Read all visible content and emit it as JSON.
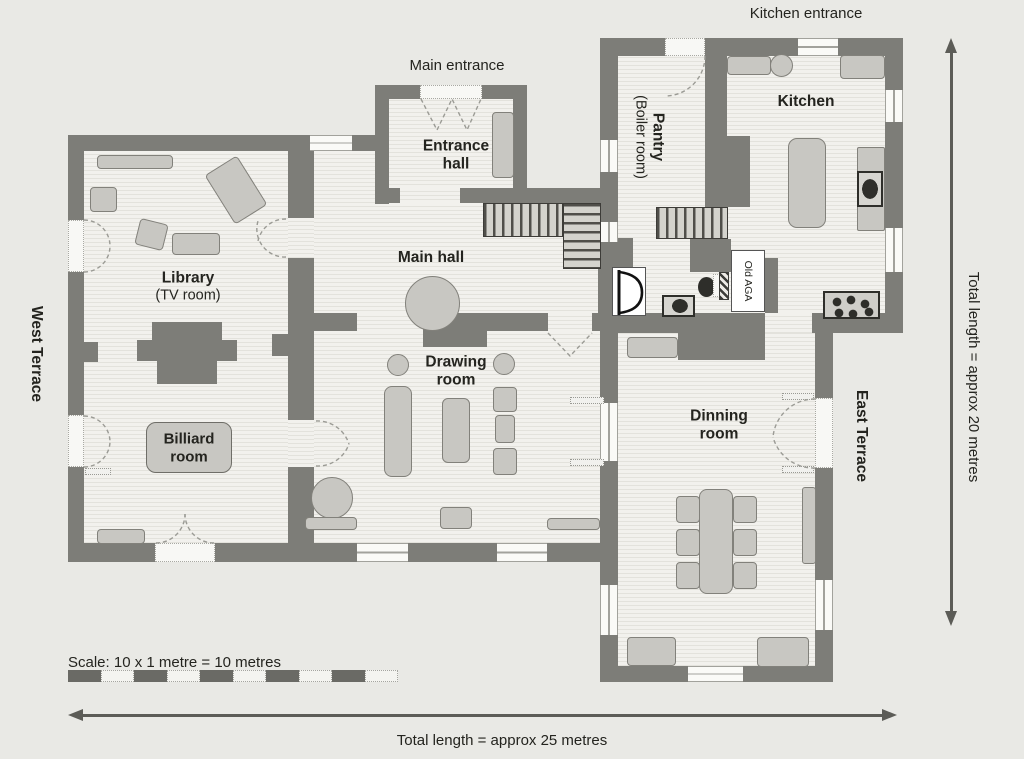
{
  "annotations": {
    "kitchen_entrance": "Kitchen entrance",
    "main_entrance": "Main entrance",
    "west_terrace": "West Terrace",
    "east_terrace": "East Terrace",
    "scale_label": "Scale: 10 x 1 metre = 10 metres",
    "total_width_label": "Total length = approx 25 metres",
    "total_height_label": "Total length = approx 20 metres"
  },
  "rooms": {
    "library": {
      "name": "Library",
      "subtitle": "(TV room)"
    },
    "billiard": {
      "line1": "Billiard",
      "line2": "room"
    },
    "entrance_hall": {
      "line1": "Entrance",
      "line2": "hall"
    },
    "main_hall": {
      "name": "Main hall"
    },
    "drawing_room": {
      "line1": "Drawing",
      "line2": "room"
    },
    "dinning_room": {
      "line1": "Dinning",
      "line2": "room"
    },
    "kitchen": {
      "name": "Kitchen"
    },
    "pantry": {
      "line1": "Pantry",
      "line2": "(Boiler room)"
    },
    "old_aga": {
      "name": "Old AGA"
    }
  },
  "colors": {
    "wall": "#7d7d78",
    "floor": "#f2f1ed",
    "floor_stripe": "#e3e2dc",
    "furniture": "#c8c7c2",
    "paper": "#e9e9e5",
    "ink": "#262624",
    "arrow": "#5c5c57"
  }
}
